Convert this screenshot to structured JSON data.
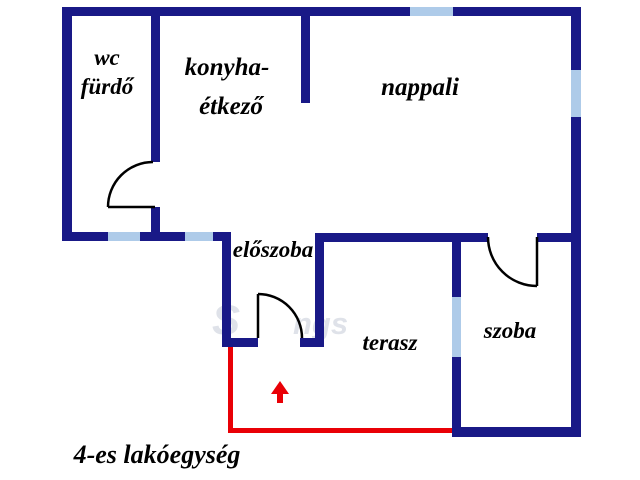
{
  "floor_plan": {
    "caption": "4-es lakóegység",
    "rooms": {
      "wc_furdo": {
        "line1": "wc",
        "line2": "fürdő"
      },
      "konyha_etkezo": {
        "line1": "konyha-",
        "line2": "étkező"
      },
      "nappali": {
        "label": "nappali"
      },
      "eloszoba": {
        "label": "előszoba"
      },
      "terasz": {
        "label": "terasz"
      },
      "szoba": {
        "label": "szoba"
      }
    },
    "watermark": {
      "fragments": [
        "S",
        "ngs"
      ]
    },
    "colors": {
      "wall": "#191987",
      "window": "#aecbe9",
      "unit_boundary": "#e90006",
      "entrance_arrow": "#e90006",
      "door": "#000000",
      "label": "#000000",
      "background": "#ffffff"
    },
    "icons": {
      "entrance_arrow": "up-arrow"
    }
  }
}
